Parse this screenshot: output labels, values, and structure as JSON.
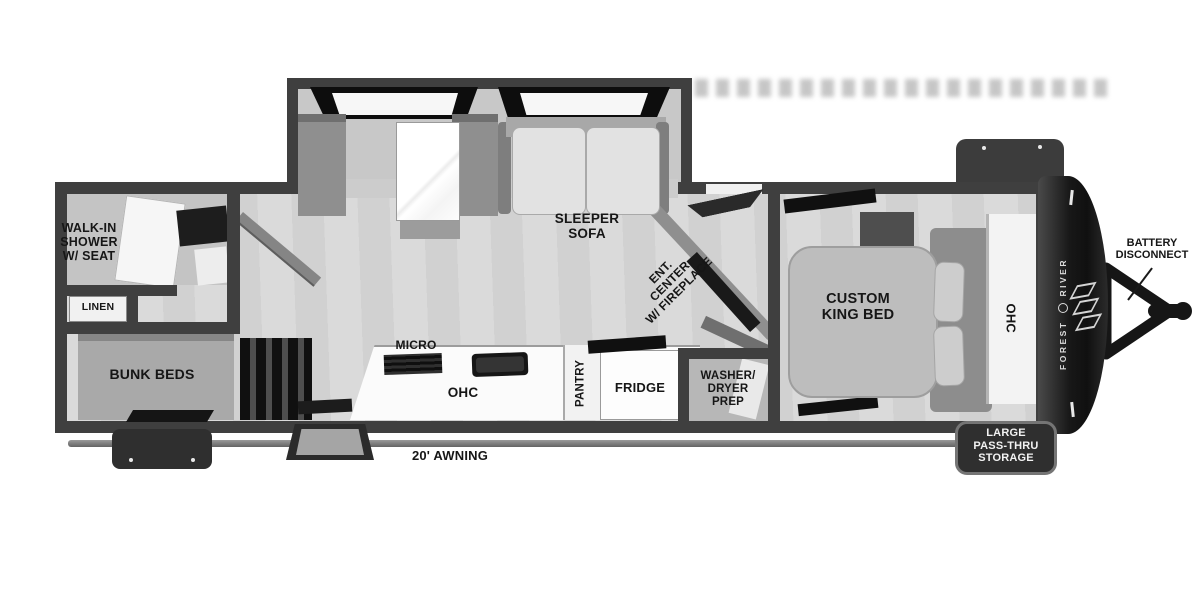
{
  "title": "Travel trailer floor plan",
  "colors": {
    "wall": "#3f3f3f",
    "floor": "#d7d7d7",
    "counter": "#fbfbfb",
    "furniture_gray": "#9b9b9b",
    "cap_black": "#1c1c1c",
    "label_black": "#161616",
    "badge_white": "#f2f2f2"
  },
  "labels": {
    "shower": [
      "WALK-IN",
      "SHOWER",
      "W/ SEAT"
    ],
    "linen": "LINEN",
    "bunks": "BUNK BEDS",
    "sleeper_sofa": [
      "SLEEPER",
      "SOFA"
    ],
    "micro": "MICRO",
    "kitchen_ohc": "OHC",
    "pantry": "PANTRY",
    "fridge": "FRIDGE",
    "ent_center": [
      "ENT.",
      "CENTER",
      "W/ FIREPLACE"
    ],
    "washer": [
      "WASHER/",
      "DRYER",
      "PREP"
    ],
    "king_bed": [
      "CUSTOM",
      "KING BED"
    ],
    "bedroom_ohc": "OHC",
    "battery": [
      "BATTERY",
      "DISCONNECT"
    ],
    "pass_thru": [
      "LARGE",
      "PASS-THRU",
      "STORAGE"
    ],
    "awning": "20' AWNING",
    "brand": [
      "FOREST",
      "RIVER"
    ]
  }
}
